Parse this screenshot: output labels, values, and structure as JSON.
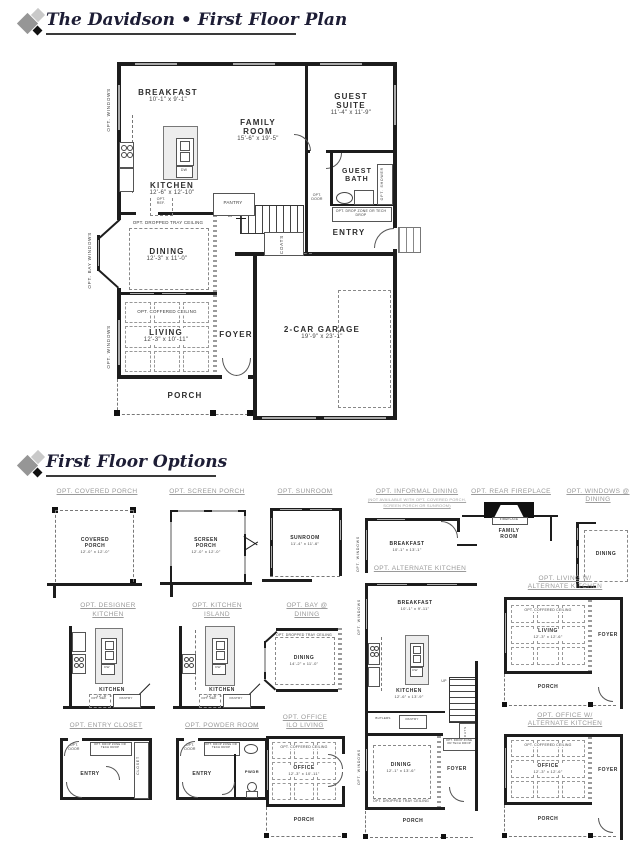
{
  "header": {
    "plan_title": "The Davidson • First Floor Plan",
    "options_title": "First Floor Options"
  },
  "plan": {
    "breakfast": {
      "name": "BREAKFAST",
      "dims": "10'-1\" x 9'-1\""
    },
    "family_room": {
      "name": "FAMILY ROOM",
      "dims": "15'-6\" x 19'-5\""
    },
    "guest_suite": {
      "name": "GUEST SUITE",
      "dims": "11'-4\" x 11'-9\""
    },
    "kitchen": {
      "name": "KITCHEN",
      "dims": "12'-6\" x 12'-10\""
    },
    "guest_bath": {
      "name": "GUEST BATH"
    },
    "entry": {
      "name": "ENTRY"
    },
    "dining": {
      "name": "DINING",
      "dims": "12'-3\" x 11'-0\""
    },
    "living": {
      "name": "LIVING",
      "dims": "12'-3\" x 10'-11\""
    },
    "foyer": {
      "name": "FOYER"
    },
    "garage": {
      "name": "2-CAR GARAGE",
      "dims": "19'-9\" x 23'-1\""
    },
    "porch": {
      "name": "PORCH"
    },
    "labels": {
      "opt_windows": "OPT. WINDOWS",
      "opt_bay_windows": "OPT. BAY WINDOWS",
      "opt_dropped_tray": "OPT. DROPPED TRAY CEILING",
      "opt_coffered": "OPT. COFFERED CEILING",
      "pantry": "PANTRY",
      "dw": "DW",
      "opt_ref": "OPT. REF.",
      "up": "UP",
      "coats": "COATS",
      "opt_door": "OPT. DOOR",
      "opt_shower": "OPT. SHOWER",
      "drop_zone": "OPT. DROP ZONE OR TECH DROP"
    }
  },
  "options": {
    "covered_porch": {
      "title": "OPT. COVERED PORCH",
      "room": "COVERED PORCH",
      "dims": "12'-0\" x 12'-0\""
    },
    "screen_porch": {
      "title": "OPT. SCREEN PORCH",
      "room": "SCREEN PORCH",
      "dims": "12'-0\" x 12'-0\""
    },
    "sunroom": {
      "title": "OPT. SUNROOM",
      "room": "SUNROOM",
      "dims": "11'-4\" x 11'-6\""
    },
    "informal_dining": {
      "title": "OPT. INFORMAL DINING",
      "note1": "(NOT AVAILABLE WITH OPT. COVERED PORCH,",
      "note2": "SCREEN PORCH OR SUNROOM)",
      "room": "BREAKFAST",
      "dims": "10'-1\" x 13'-1\"",
      "opt_windows": "OPT. WINDOWS"
    },
    "rear_fireplace": {
      "title": "OPT. REAR FIREPLACE",
      "fireplace": "FIREPLACE",
      "room": "FAMILY ROOM"
    },
    "windows_dining": {
      "title1": "OPT. WINDOWS @",
      "title2": "DINING",
      "room": "DINING"
    },
    "designer_kitchen": {
      "title1": "OPT. DESIGNER",
      "title2": "KITCHEN",
      "room": "KITCHEN",
      "dims": "12'-6\" x 12'-10\"",
      "pantry": "PANTRY",
      "opt_ref": "OPT. REF.",
      "dw": "DW"
    },
    "kitchen_island": {
      "title1": "OPT. KITCHEN",
      "title2": "ISLAND",
      "room": "KITCHEN",
      "dims": "12'-6\" x 12'-10\"",
      "pantry": "PANTRY",
      "opt_ref": "OPT. REF.",
      "dw": "DW"
    },
    "bay_dining": {
      "title1": "OPT. BAY @",
      "title2": "DINING",
      "ceiling": "OPT. DROPPED TRAY CEILING",
      "room": "DINING",
      "dims": "14'-2\" x 11'-0\""
    },
    "alternate_kitchen": {
      "title": "OPT. ALTERNATE KITCHEN",
      "breakfast": "BREAKFAST",
      "breakfast_dims": "10'-1\" x 9'-11\"",
      "kitchen": "KITCHEN",
      "kitchen_dims": "12'-6\" x 13'-9\"",
      "butlers": "BUTLERS",
      "pantry": "PANTRY",
      "up": "UP",
      "coats": "COATS",
      "dining": "DINING",
      "dining_dims": "12'-1\" x 13'-6\"",
      "tray": "OPT. DROPPED TRAY CEILING",
      "foyer": "FOYER",
      "porch": "PORCH",
      "drop_zone": "OPT. DROP ZONE OR TECH DROP",
      "opt_windows": "OPT. WINDOWS",
      "dw": "DW"
    },
    "living_alt_kitchen": {
      "title1": "OPT. LIVING W/",
      "title2": "ALTERNATE KITCHEN",
      "ceiling": "OPT. COFFERED CEILING",
      "room": "LIVING",
      "dims": "12'-3\" x 12'-6\"",
      "foyer": "FOYER",
      "porch": "PORCH"
    },
    "entry_closet": {
      "title": "OPT. ENTRY CLOSET",
      "room": "ENTRY",
      "closet": "CLOSET",
      "opt_door": "OPT. DOOR",
      "drop_zone": "OPT. DROP ZONE OR TECH DROP"
    },
    "powder_room": {
      "title": "OPT. POWDER ROOM",
      "room": "ENTRY",
      "pwdr": "PWDR",
      "opt_door": "OPT. DOOR",
      "drop_zone": "OPT. DROP ZONE OR TECH DROP"
    },
    "office_ilo_living": {
      "title1": "OPT. OFFICE",
      "title2": "ILO LIVING",
      "ceiling": "OPT. COFFERED CEILING",
      "room": "OFFICE",
      "dims": "12'-3\" x 10'-11\"",
      "porch": "PORCH"
    },
    "office_alt_kitchen": {
      "title1": "OPT. OFFICE W/",
      "title2": "ALTERNATE KITCHEN",
      "ceiling": "OPT. COFFERED CEILING",
      "room": "OFFICE",
      "dims": "12'-3\" x 12'-6\"",
      "foyer": "FOYER",
      "porch": "PORCH"
    }
  }
}
